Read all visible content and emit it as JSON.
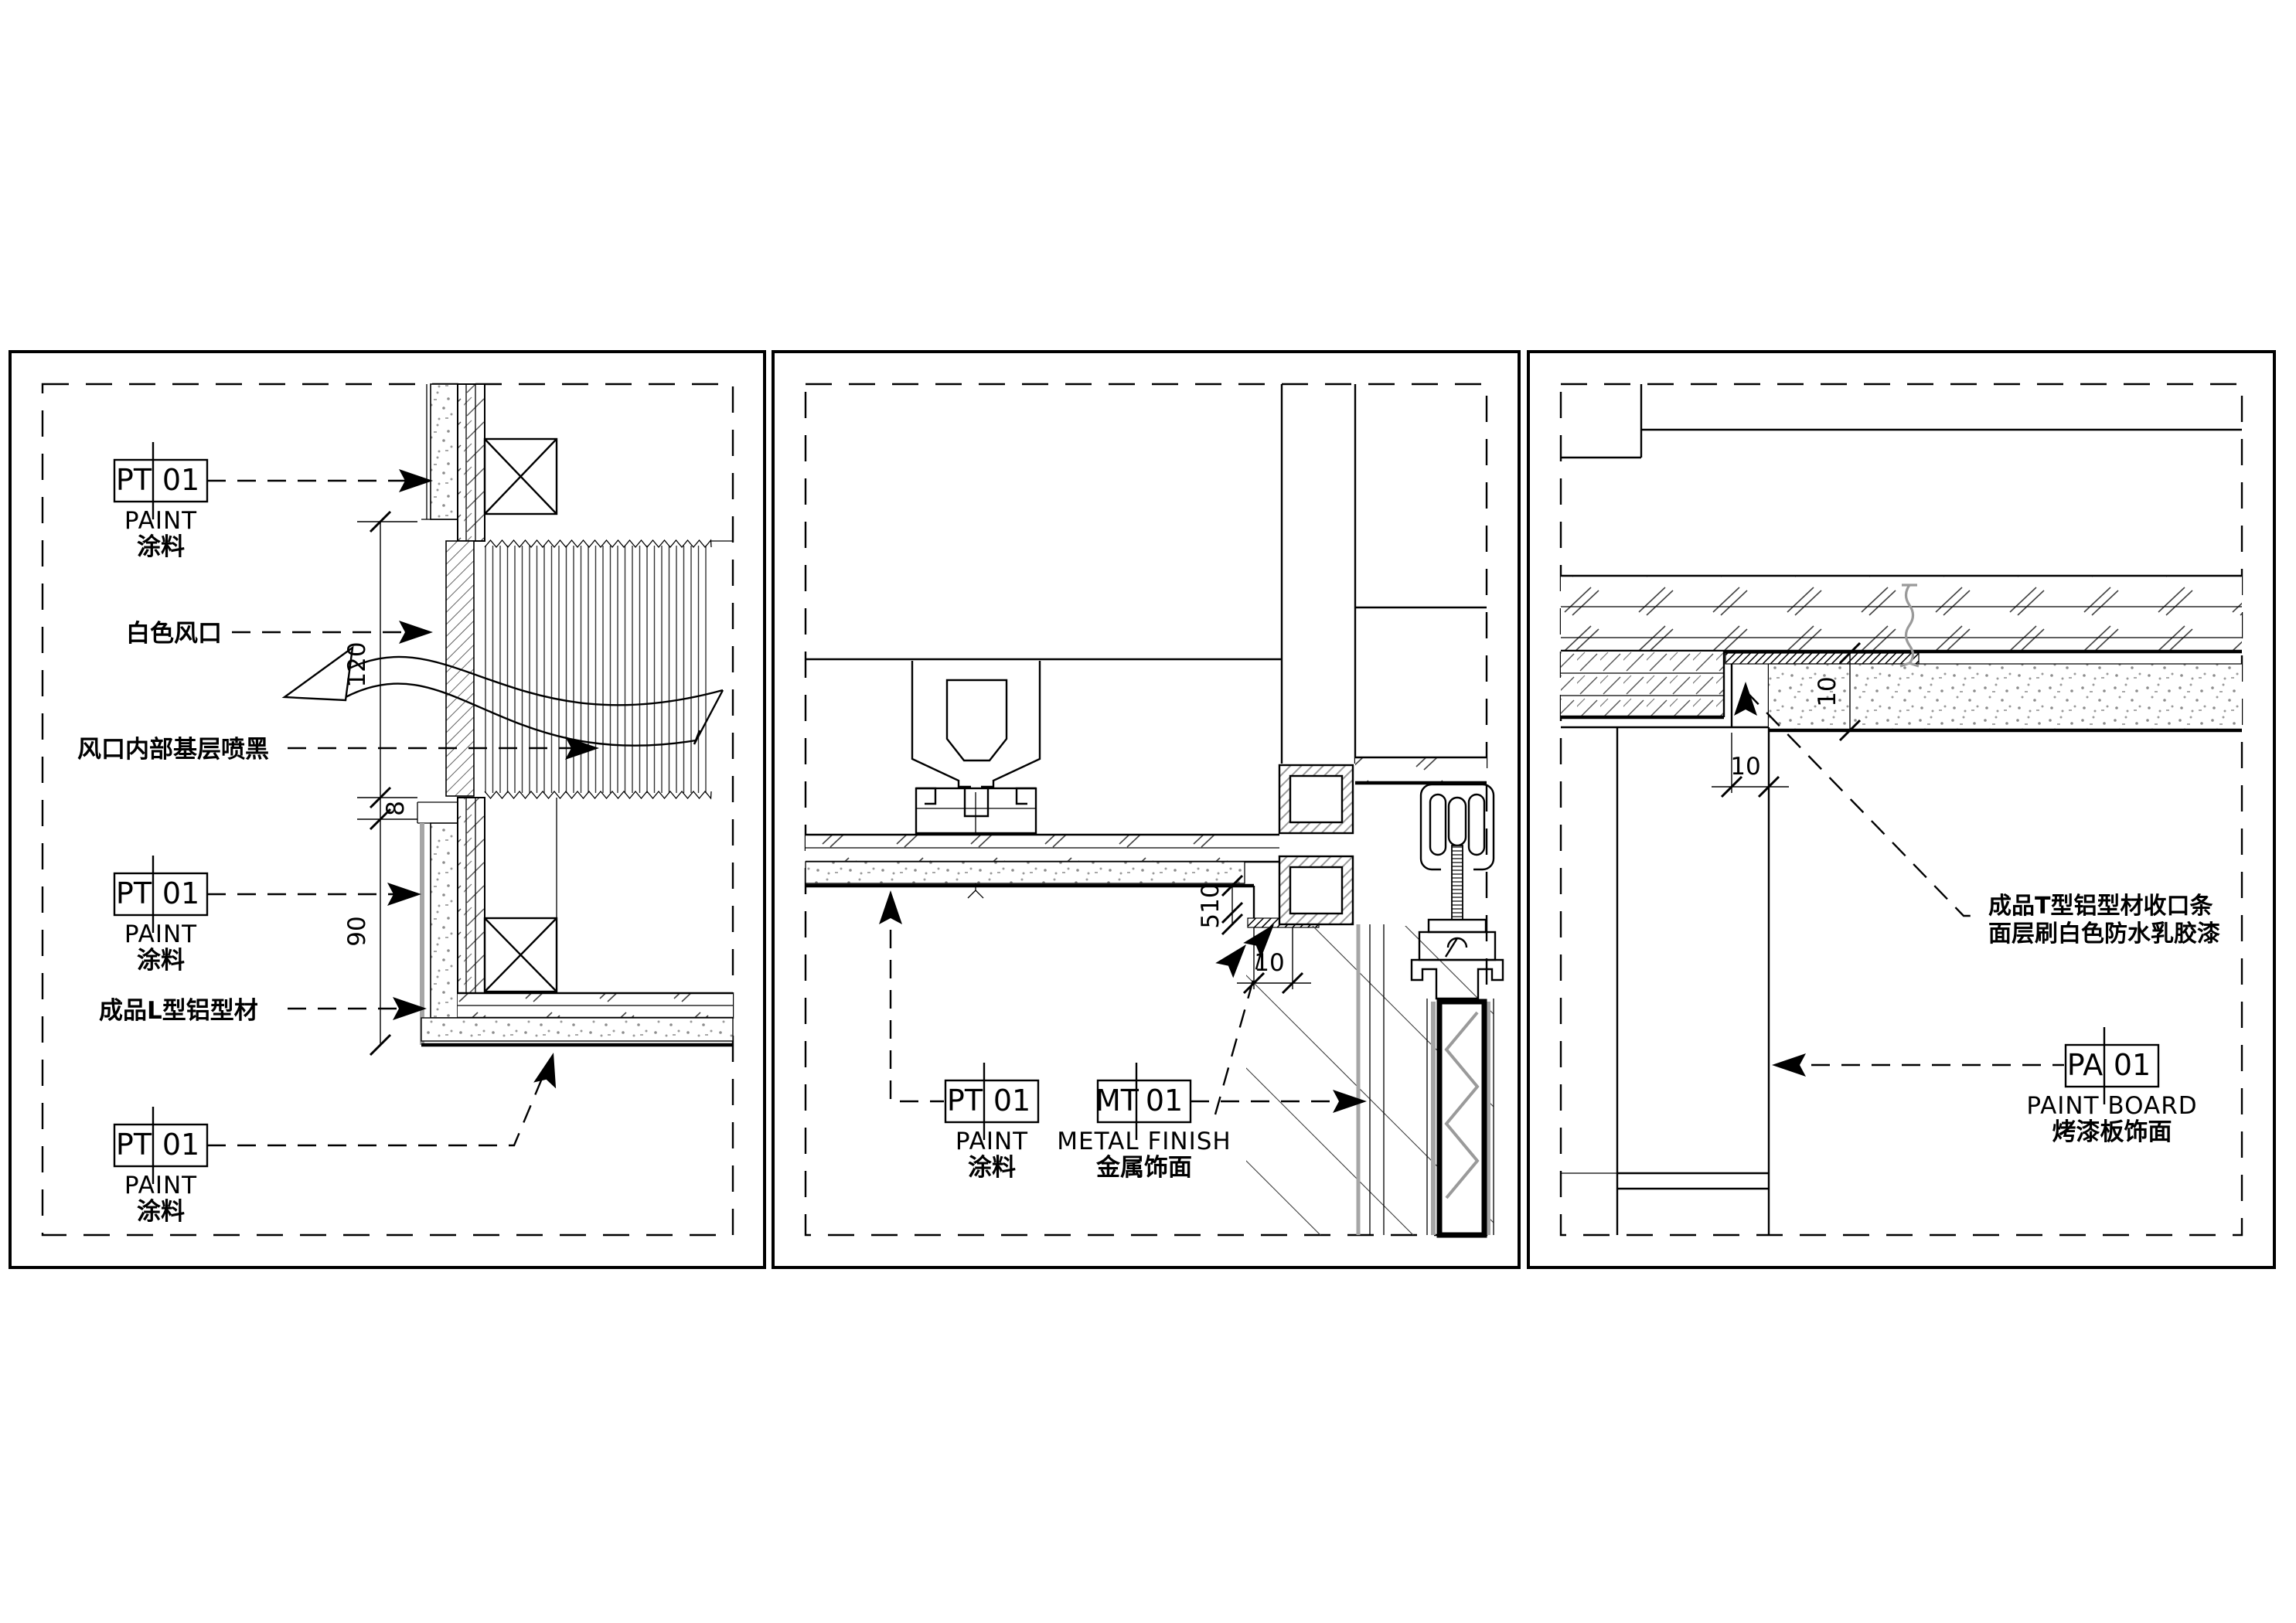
{
  "drawing": {
    "bg": "#ffffff",
    "ink": "#000000",
    "gray": "#9a9a9a"
  },
  "panel_left": {
    "tag_top": {
      "code": "PT",
      "num": "01",
      "en": "PAINT",
      "cn": "涂料"
    },
    "label_vent": "白色风口",
    "label_vent_inner": "风口内部基层喷黑",
    "label_l_profile": "成品L型铝型材",
    "tag_mid": {
      "code": "PT",
      "num": "01",
      "en": "PAINT",
      "cn": "涂料"
    },
    "tag_bottom": {
      "code": "PT",
      "num": "01",
      "en": "PAINT",
      "cn": "涂料"
    },
    "dims": {
      "vent_height": "120",
      "step": "8",
      "lower": "90"
    }
  },
  "panel_middle": {
    "tag_paint": {
      "code": "PT",
      "num": "01",
      "en": "PAINT",
      "cn": "涂料"
    },
    "tag_metal": {
      "code": "MT",
      "num": "01",
      "en": "METAL FINISH",
      "cn": "金属饰面"
    },
    "dims": {
      "edge": "510",
      "reveal": "10"
    }
  },
  "panel_right": {
    "note": {
      "line1": "成品T型铝型材收口条",
      "line2": "面层刷白色防水乳胶漆"
    },
    "tag_board": {
      "code": "PA",
      "num": "01",
      "en": "PAINT BOARD",
      "cn": "烤漆板饰面"
    },
    "dims": {
      "board_thk": "10",
      "reveal": "10"
    }
  }
}
